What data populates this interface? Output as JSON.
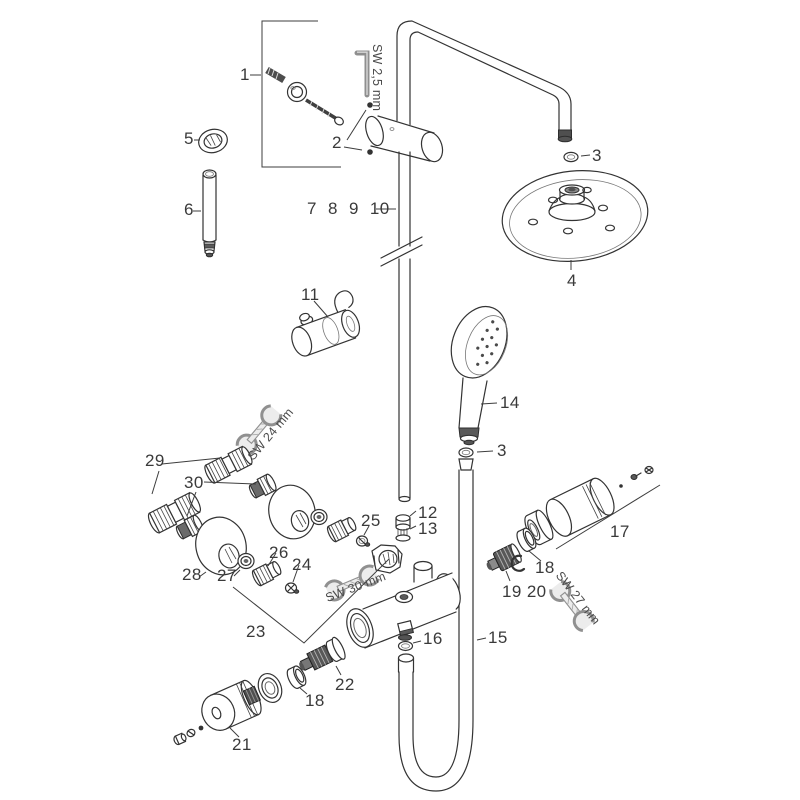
{
  "diagram": {
    "kind": "exploded-parts-diagram-shower-system",
    "colors": {
      "background": "#ffffff",
      "line": "#333333",
      "label": "#3a3a3a",
      "tool_metal": "#ececec"
    },
    "labels": [
      {
        "part": "holder-screw-set",
        "text": "1"
      },
      {
        "part": "allen-key-size",
        "text": "SW 2,5 mm"
      },
      {
        "part": "mounting-screws",
        "text": "2"
      },
      {
        "part": "ring-nut",
        "text": "5"
      },
      {
        "part": "extension-pipe",
        "text": "6"
      },
      {
        "part": "riser-pipe-set",
        "text": "7 8 9 10"
      },
      {
        "part": "gasket-arm",
        "text": "3"
      },
      {
        "part": "overhead-shower",
        "text": "4"
      },
      {
        "part": "slider-holder",
        "text": "11"
      },
      {
        "part": "hand-shower",
        "text": "14"
      },
      {
        "part": "gasket-hose",
        "text": "3"
      },
      {
        "part": "s-connectors",
        "text": "29"
      },
      {
        "part": "adapters",
        "text": "30"
      },
      {
        "part": "wrench-24-size",
        "text": "SW 24 mm"
      },
      {
        "part": "escutcheon",
        "text": "28"
      },
      {
        "part": "nut",
        "text": "27"
      },
      {
        "part": "connector",
        "text": "26"
      },
      {
        "part": "screw",
        "text": "24"
      },
      {
        "part": "screw-small",
        "text": "25"
      },
      {
        "part": "filter-ring",
        "text": "12"
      },
      {
        "part": "filter-insert",
        "text": "13"
      },
      {
        "part": "connection-set",
        "text": "23"
      },
      {
        "part": "wrench-30-size",
        "text": "SW 30 mm"
      },
      {
        "part": "handle",
        "text": "17"
      },
      {
        "part": "ring-right",
        "text": "18"
      },
      {
        "part": "cartridge-clip-set",
        "text": "19 20"
      },
      {
        "part": "wrench-27-size",
        "text": "SW 27 mm"
      },
      {
        "part": "outlet-gasket",
        "text": "16"
      },
      {
        "part": "shower-hose",
        "text": "15"
      },
      {
        "part": "cartridge",
        "text": "22"
      },
      {
        "part": "ring-bottom",
        "text": "18"
      },
      {
        "part": "handle-knob",
        "text": "21"
      }
    ]
  }
}
